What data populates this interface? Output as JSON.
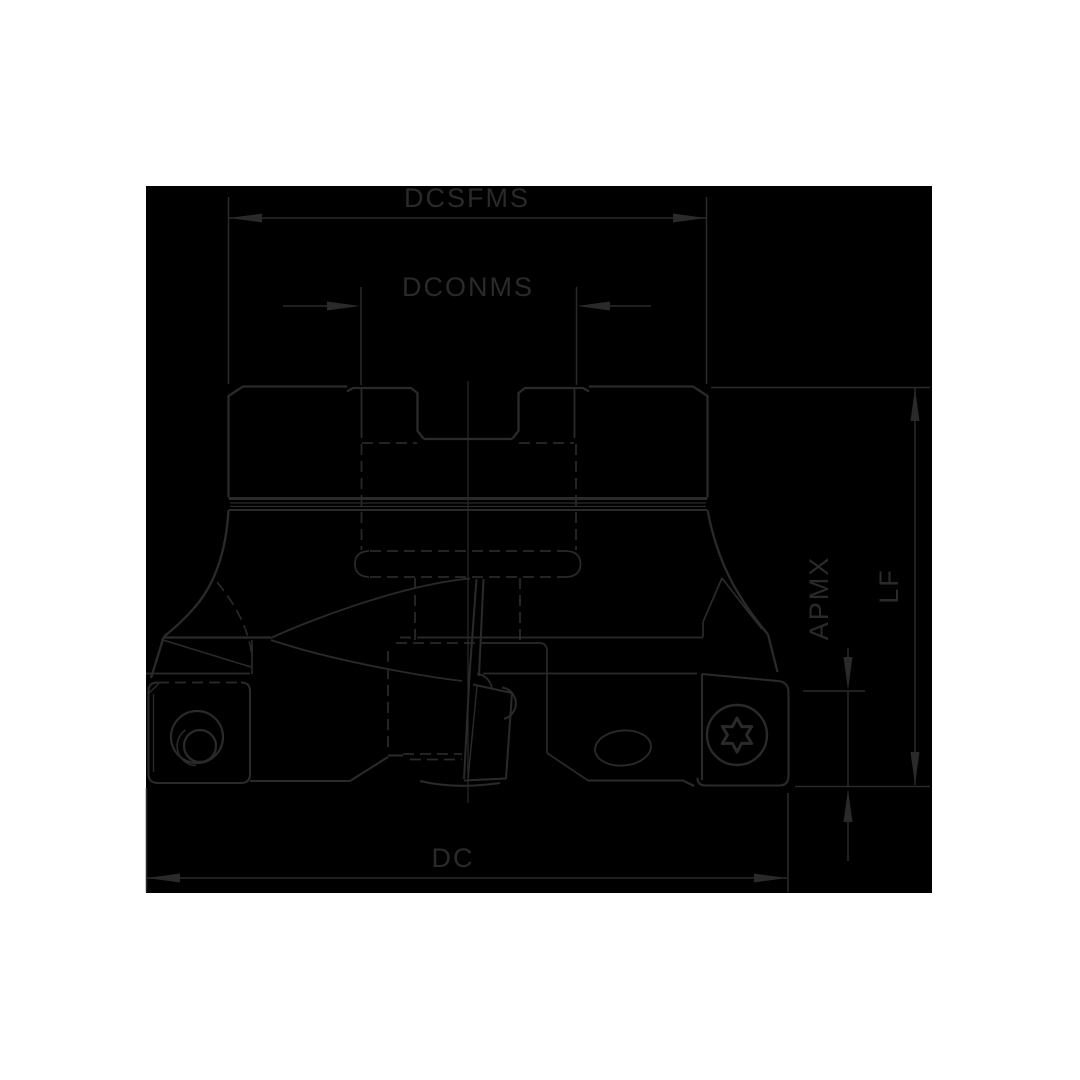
{
  "page": {
    "background_color": "#ffffff",
    "canvas_color": "#000000",
    "line_color": "#2a2a2a"
  },
  "drawing": {
    "description": "technical-line-drawing-face-milling-cutter-side-view",
    "labels": {
      "dcsfms": "DCSFMS",
      "dconms": "DCONMS",
      "dc": "DC",
      "lf": "LF",
      "apmx": "APMX"
    }
  }
}
